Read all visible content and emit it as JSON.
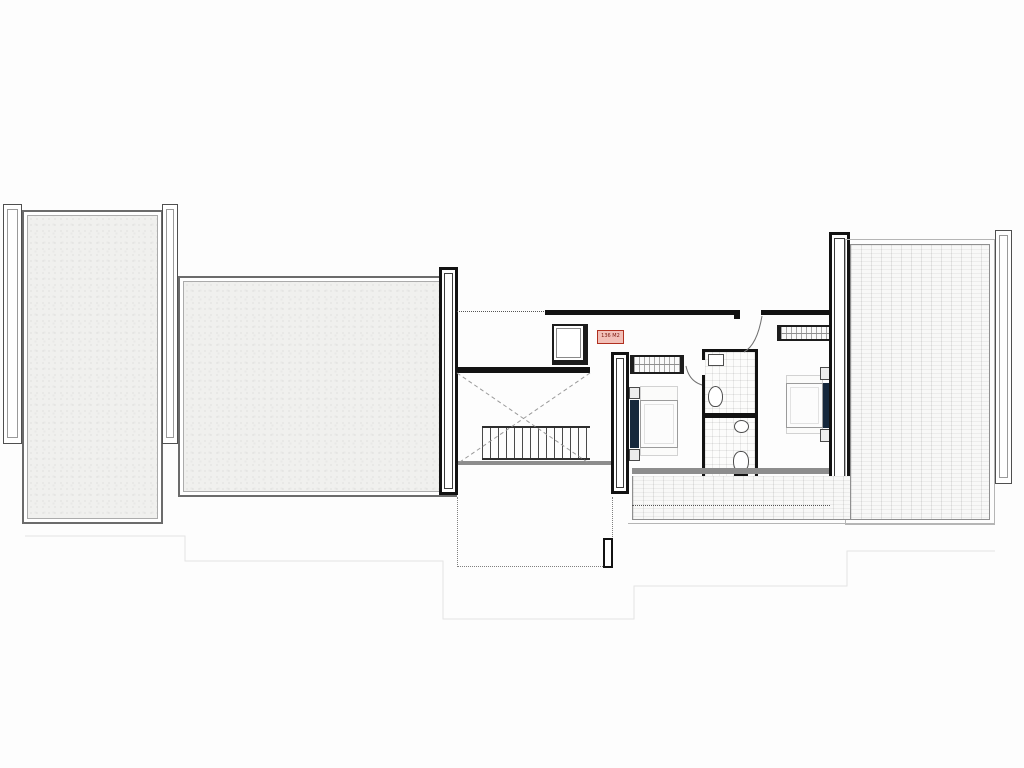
{
  "plan": {
    "area_label": "136 M2",
    "colors": {
      "wall_black": "#121212",
      "wall_gray": "#8d8d8d",
      "room_fill": "#f0f0ee",
      "headboard_navy": "#16283c",
      "label_border": "#b03020",
      "label_bg": "#f2c0b8",
      "label_text": "#7a150c"
    }
  }
}
